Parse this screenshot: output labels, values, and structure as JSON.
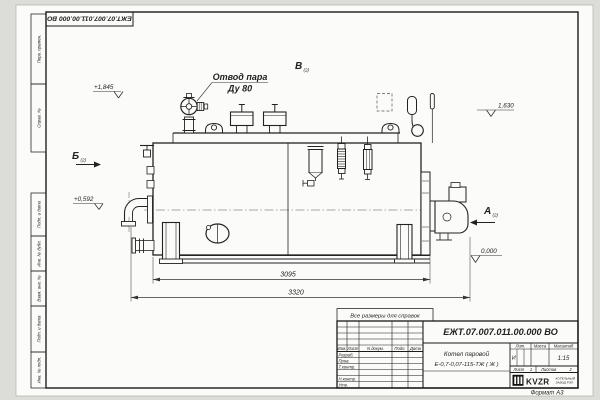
{
  "frame": {
    "designation_rotated": "ЕЖТ.07.007.011.00.000  ВО",
    "format_note": "Формат А3",
    "side_labels": [
      "Перв. примен.",
      "Справ. №",
      "Подп. и дата",
      "Инв. № дубл.",
      "Взам. инв. №",
      "Подп. и дата",
      "Инв. № подл."
    ]
  },
  "note": {
    "text": "Все размеры для справок"
  },
  "callouts": {
    "steam_outlet": {
      "line1": "Отвод пара",
      "line2": "Ду 80"
    }
  },
  "levels": {
    "valve_top": "+1,845",
    "fittings_top": "1,630",
    "pipe_axis": "+0,592",
    "floor": "0,000"
  },
  "views": {
    "a": "А",
    "b": "Б",
    "v": "В",
    "ref": "(2)"
  },
  "dims": {
    "shell_length": "3095",
    "overall_length": "3320"
  },
  "title_block": {
    "designation": "ЕЖТ.07.007.011.00.000  ВО",
    "name_line1": "Котел паровой",
    "name_line2": "Е-0,7-0,07-115-ТЖ ( Ж )",
    "header_cols": [
      "Изм.",
      "Лист",
      "N докум.",
      "Подп.",
      "Дата"
    ],
    "sig_rows": [
      "Разраб.",
      "Пров.",
      "Т.контр.",
      "Н.контр.",
      "Утв."
    ],
    "lit_label": "Лит.",
    "lit_value": "И",
    "mass_label": "Масса",
    "scale_label": "Масштаб",
    "scale_value": "1:15",
    "sheet_label": "Лист",
    "sheet_value": "1",
    "sheets_label": "Листов",
    "sheets_value": "2",
    "logo_text": "KVZR",
    "company_line1": "КОТЕЛЬНЫЙ",
    "company_line2": "ЗАВОД РЭП"
  }
}
